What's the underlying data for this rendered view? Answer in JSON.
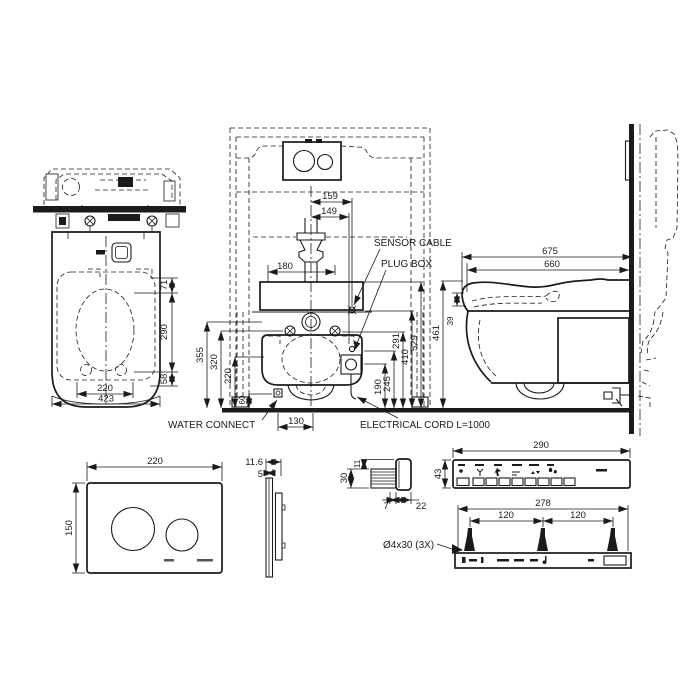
{
  "drawing": {
    "labels": {
      "sensor_cable": "SENSOR CABLE",
      "plug_box": "PLUG BOX",
      "water_connect": "WATER CONNECT",
      "electrical_cord": "ELECTRICAL CORD L=1000"
    },
    "top_view": {
      "d71": "71",
      "d290": "290",
      "d58": "58",
      "d220": "220",
      "d423": "423"
    },
    "front_view": {
      "d159": "159",
      "d149": "149",
      "d180": "180",
      "d355": "355",
      "d320": "320",
      "d220": "220",
      "d60": "60",
      "d130": "130",
      "d190": "190",
      "d245": "245",
      "d291": "291",
      "d410": "410",
      "d529": "529"
    },
    "side_view": {
      "d675": "675",
      "d660": "660",
      "d461": "461",
      "d39": "39"
    },
    "plate_front": {
      "d220": "220",
      "d150": "150"
    },
    "plate_side": {
      "d11_6": "11.6",
      "d5": "5"
    },
    "remote_side": {
      "d30": "30",
      "d11": "11",
      "d7": "7",
      "d22": "22"
    },
    "remote_front": {
      "d290": "290",
      "d43": "43"
    },
    "bracket": {
      "d278": "278",
      "d120a": "120",
      "d120b": "120",
      "screw_spec": "Ø4x30 (3X)"
    }
  }
}
